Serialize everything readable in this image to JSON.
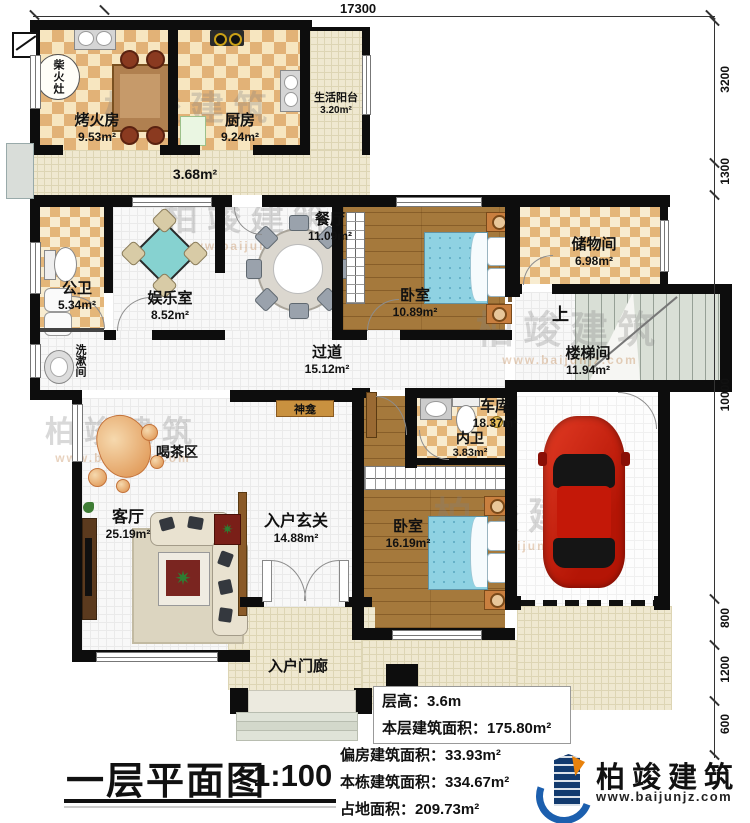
{
  "title": {
    "text": "一层平面图",
    "scale": "1:100"
  },
  "logo": {
    "name": "柏竣建筑",
    "url": "www.baijunjz.com"
  },
  "watermark": {
    "text": "柏竣建筑",
    "url": "www.baijunjz.com"
  },
  "stats": [
    {
      "label": "层高：",
      "value": "3.6m"
    },
    {
      "label": "本层建筑面积：",
      "value": "175.80m²"
    },
    {
      "label": "偏房建筑面积：",
      "value": "33.93m²"
    },
    {
      "label": "本栋建筑面积：",
      "value": "334.67m²"
    },
    {
      "label": "占地面积：",
      "value": "209.73m²"
    }
  ],
  "dims": {
    "top": "17300",
    "right": [
      "3200",
      "1300",
      "10000",
      "800",
      "1200",
      "600"
    ]
  },
  "rooms": {
    "kaohuofang": {
      "name": "烤火房",
      "area": "9.53m²"
    },
    "chaihuozao": {
      "name": "柴火灶"
    },
    "chufang": {
      "name": "厨房",
      "area": "9.24m²"
    },
    "yangtai": {
      "name": "生活阳台",
      "area": "3.20m²"
    },
    "annex_corridor": {
      "area": "3.68m²"
    },
    "gongwei": {
      "name": "公卫",
      "area": "5.34m²"
    },
    "xishujian": {
      "name": "洗漱间"
    },
    "yuleshi": {
      "name": "娱乐室",
      "area": "8.52m²"
    },
    "canting": {
      "name": "餐厅",
      "area": "11.09m²"
    },
    "woshi1": {
      "name": "卧室",
      "area": "10.89m²"
    },
    "chuwujian": {
      "name": "储物间",
      "area": "6.98m²"
    },
    "loutijian": {
      "name": "楼梯间",
      "area": "11.94m²",
      "up_label": "上"
    },
    "guodao": {
      "name": "过道",
      "area": "15.12m²"
    },
    "shenkan": {
      "name": "神龛"
    },
    "hechaqu": {
      "name": "喝茶区"
    },
    "keting": {
      "name": "客厅",
      "area": "25.19m²"
    },
    "xuanguan": {
      "name": "入户玄关",
      "area": "14.88m²"
    },
    "neiwei": {
      "name": "内卫",
      "area": "3.83m²"
    },
    "woshi2": {
      "name": "卧室",
      "area": "16.19m²"
    },
    "cheku": {
      "name": "车库",
      "area": "18.37m²"
    },
    "menlang": {
      "name": "入户门廊"
    }
  },
  "colors": {
    "wall": "#0d0d0d",
    "logo_blue": "#1c5fae",
    "logo_navy": "#123a6e",
    "logo_orange": "#e8820c",
    "car_red": "#cf1d10",
    "bed_blue": "#8ccfdf"
  }
}
